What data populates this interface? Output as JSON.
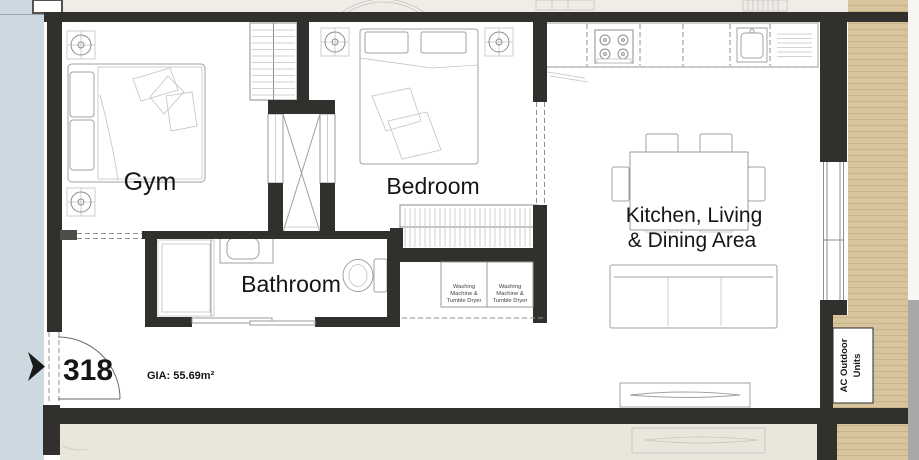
{
  "plan": {
    "unit_number": "318",
    "gia": "GIA: 55.69m²",
    "rooms": {
      "gym": "Gym",
      "bedroom": "Bedroom",
      "bathroom": "Bathroom",
      "living_line1": "Kitchen, Living",
      "living_line2": "& Dining Area"
    },
    "annotations": {
      "ac_line1": "AC Outdoor",
      "ac_line2": "Units",
      "washer": {
        "l1": "Washing",
        "l2": "Machine &",
        "l3": "Tumble Dryer"
      }
    },
    "colors": {
      "wall": "#32302d",
      "outside": "#cdd9e0",
      "neighbor_floor": "#f0ede7",
      "corridor": "#e9e7dc",
      "decking": "#d8c49d",
      "decking_stripe": "#c8b48b",
      "edge_gray": "#a8a8a8",
      "text": "#161616"
    }
  }
}
